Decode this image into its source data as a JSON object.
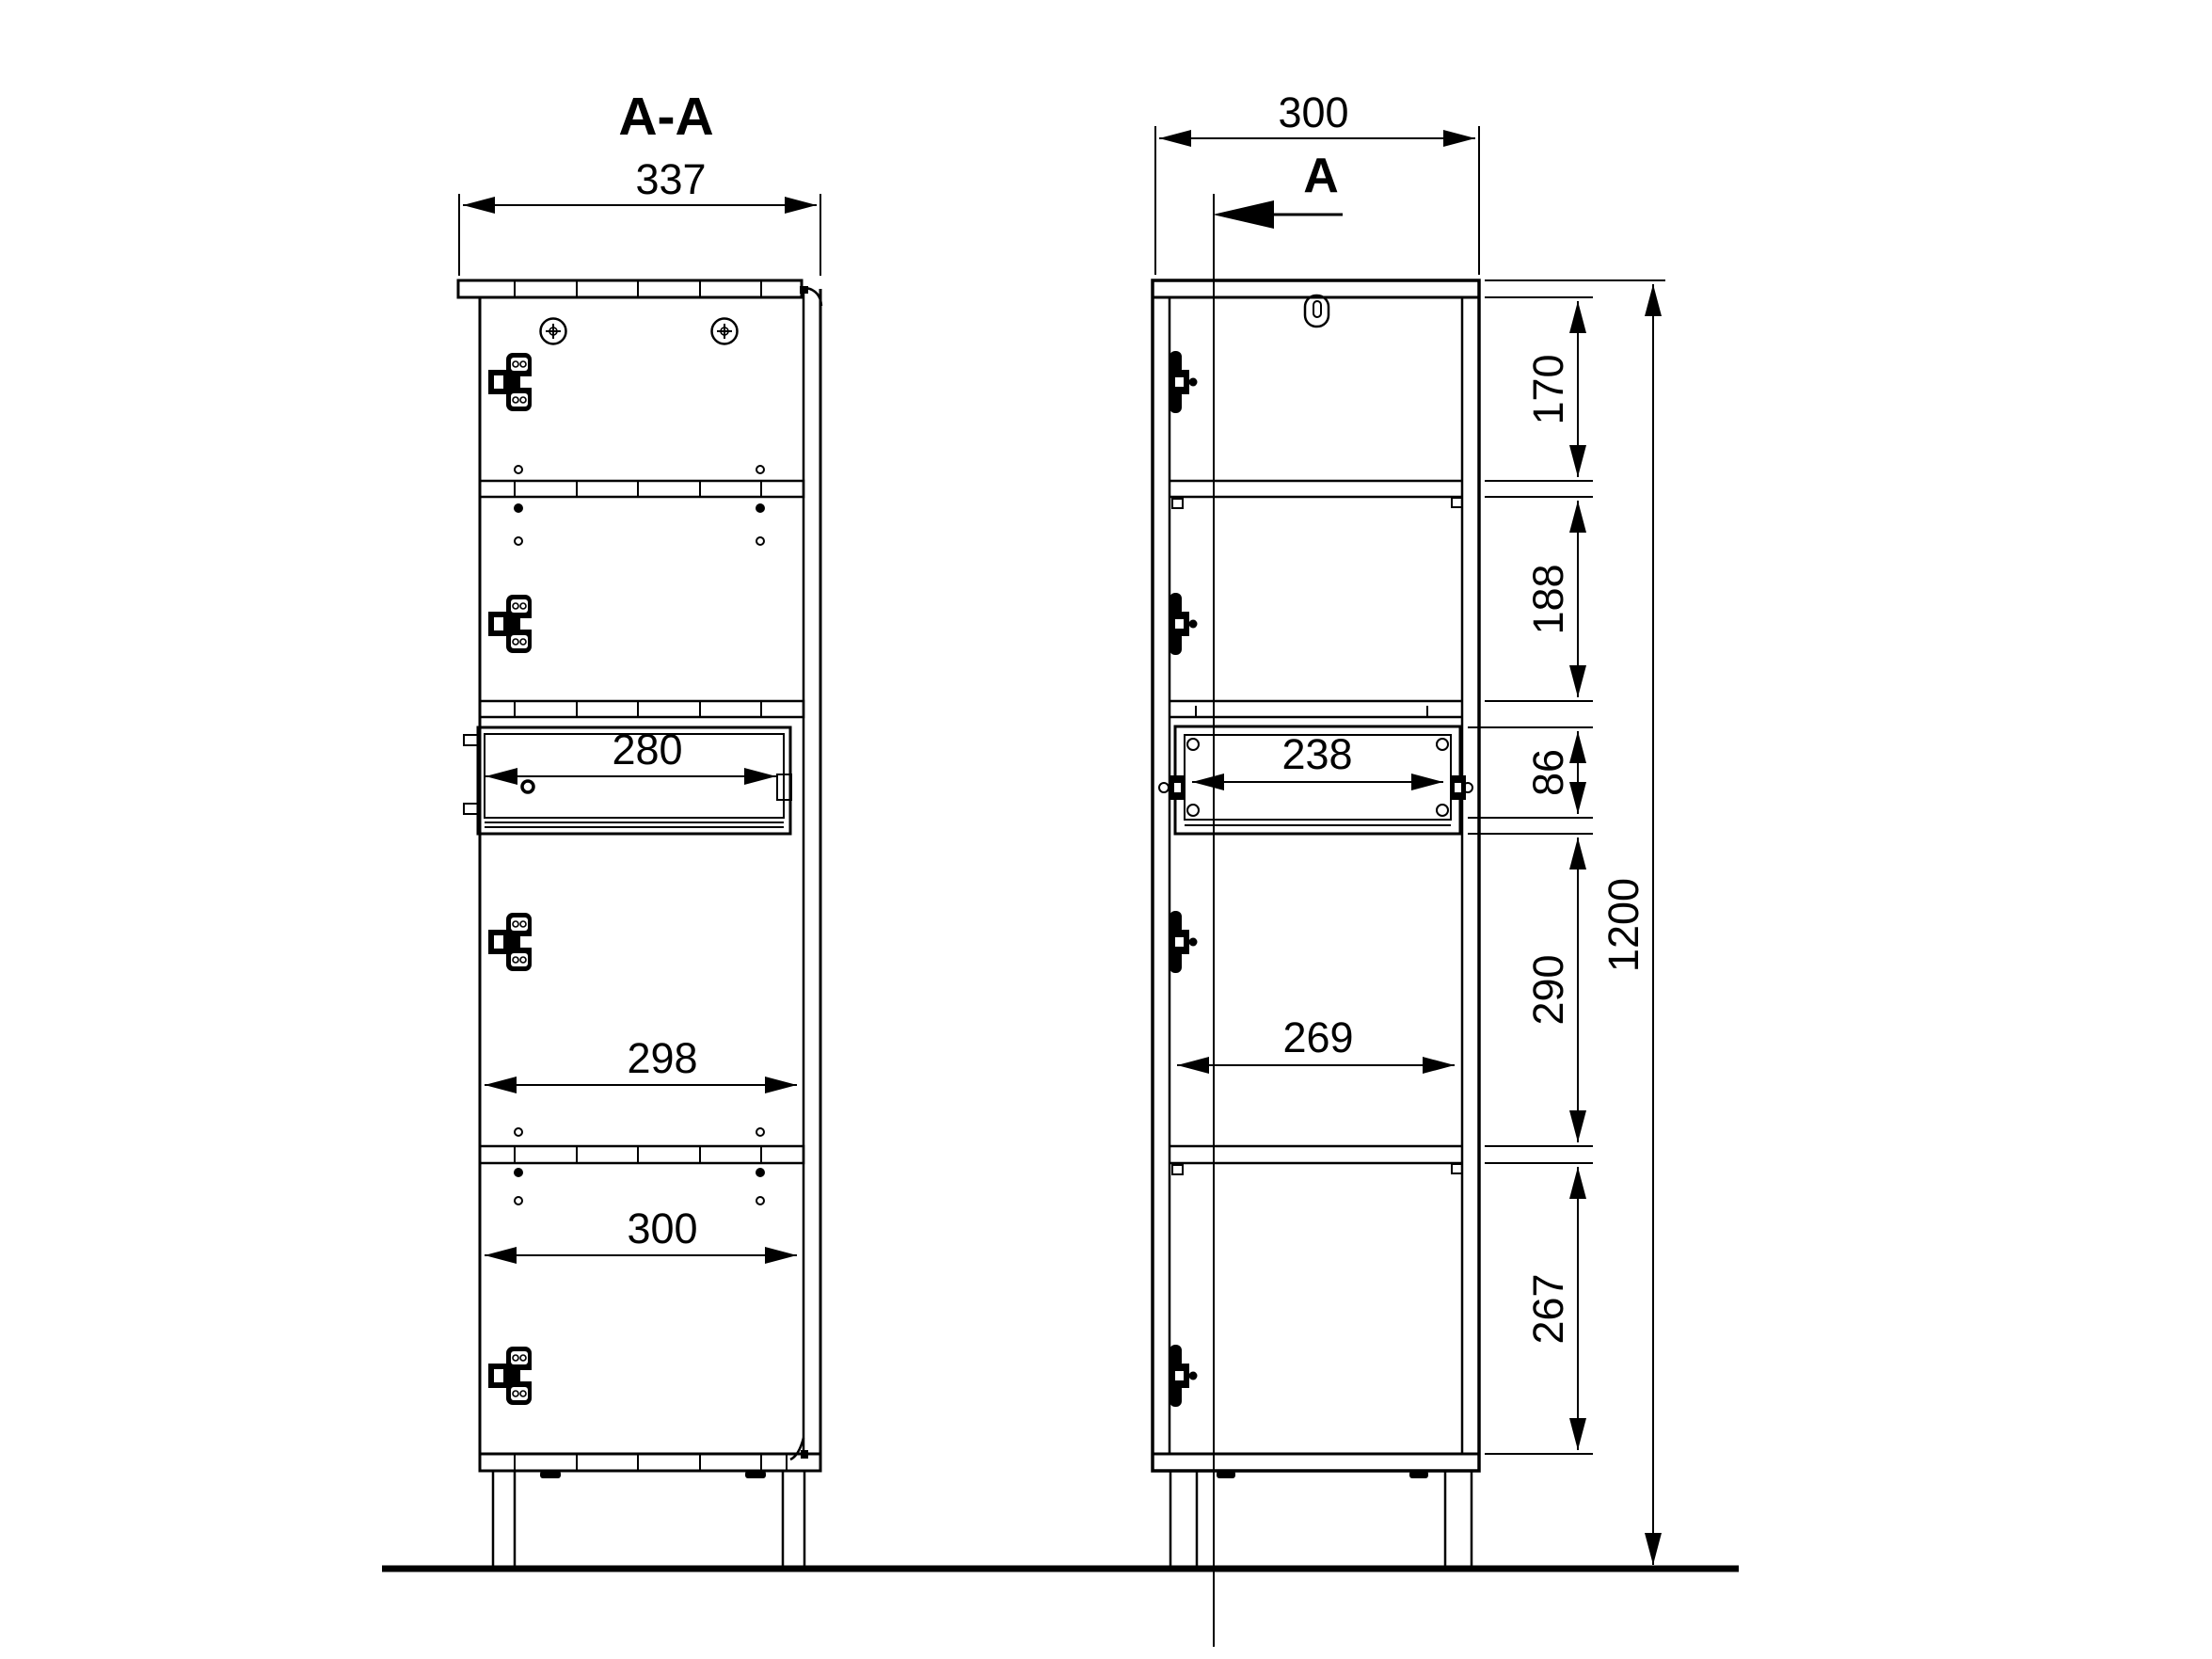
{
  "page": {
    "background": "#ffffff",
    "ink": "#000000"
  },
  "section_view": {
    "title": "A-A",
    "overall_depth": "337",
    "drawer_depth": "280",
    "inner_depth_mid": "298",
    "inner_depth_bottom": "300"
  },
  "front_view": {
    "overall_width": "300",
    "cut_label": "A",
    "drawer_width": "238",
    "inner_width": "269",
    "overall_height": "1200",
    "chain": [
      "170",
      "188",
      "86",
      "290",
      "267"
    ]
  }
}
